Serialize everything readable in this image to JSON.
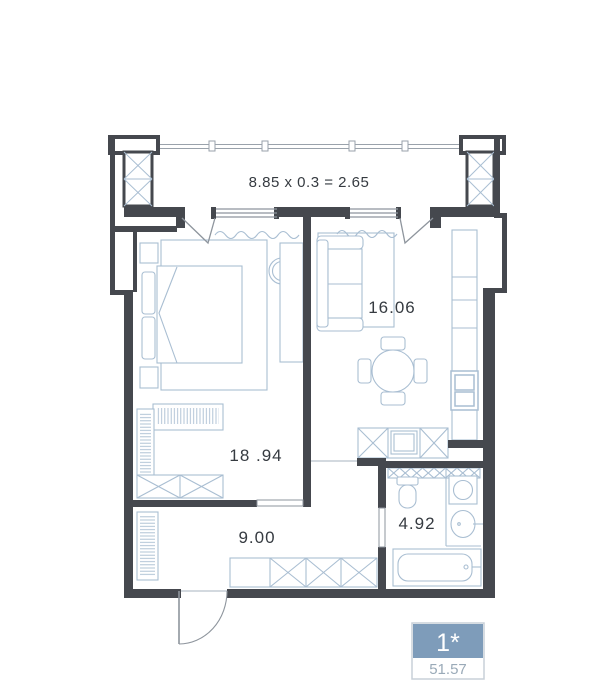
{
  "floorplan": {
    "balcony": {
      "label": "8.85 x 0.3 = 2.65"
    },
    "rooms": {
      "living": {
        "label": "16.06"
      },
      "bedroom": {
        "label": "18 .94"
      },
      "hallway": {
        "label": "9.00"
      },
      "bathroom": {
        "label": "4.92"
      }
    },
    "badge": {
      "unit": "1*",
      "area": "51.57"
    }
  },
  "colors": {
    "wall": "#45484e",
    "furniture_line": "#a9bed2",
    "thin_line": "#8e959d",
    "label_text": "#363b41",
    "badge_blue": "#7e9cba",
    "badge_border": "#c9d0d8",
    "badge_area_text": "#9aaab8"
  }
}
